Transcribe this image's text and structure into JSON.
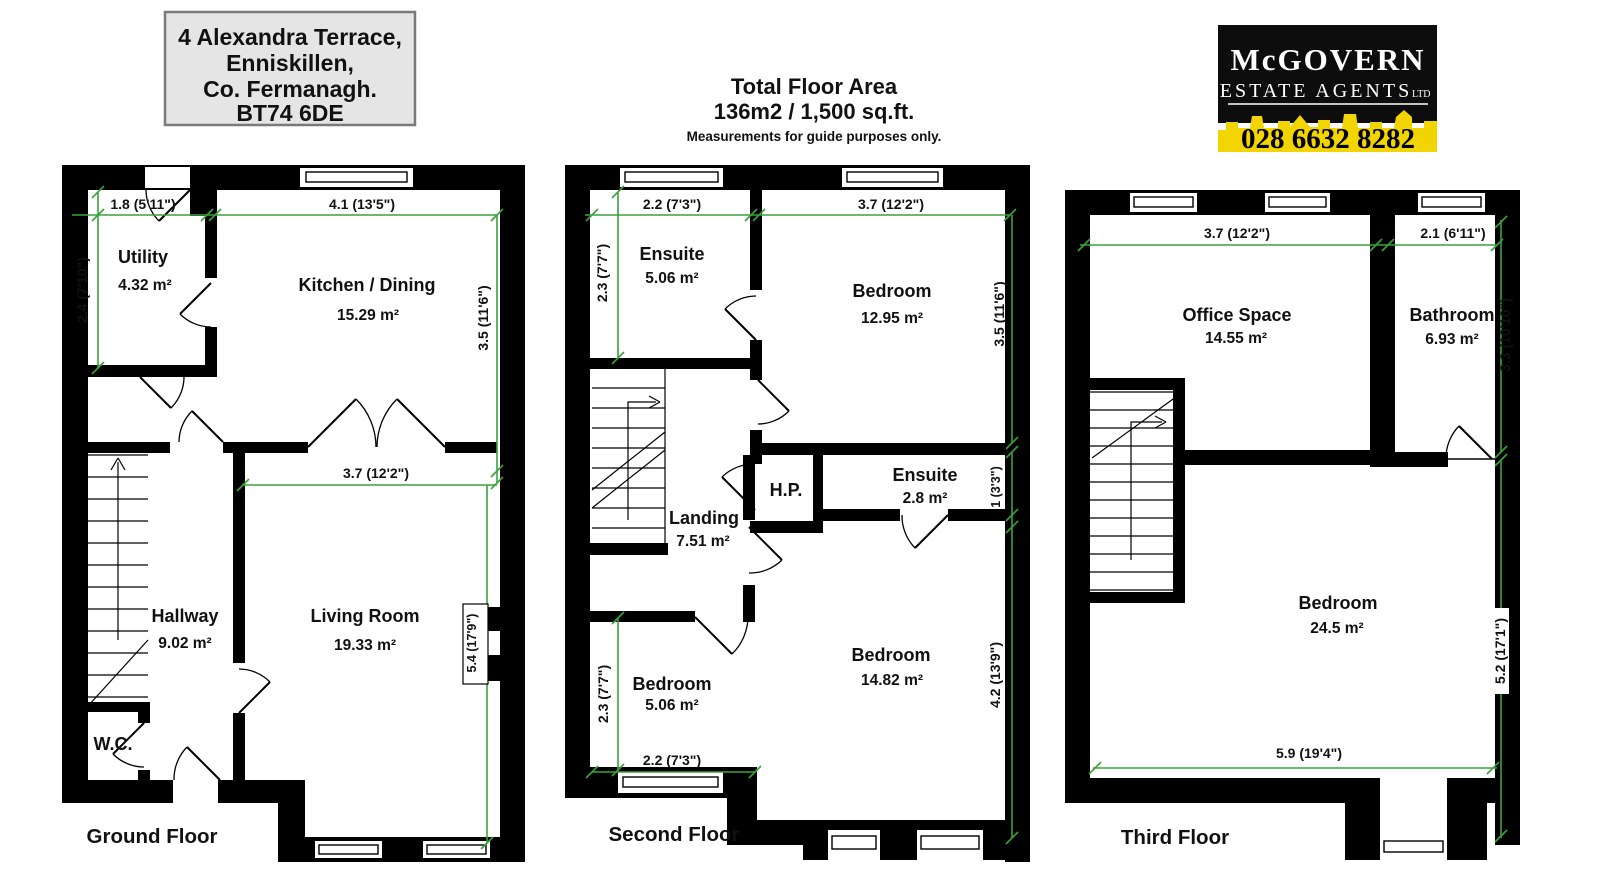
{
  "header": {
    "address": {
      "line1": "4 Alexandra Terrace,",
      "line2": "Enniskillen,",
      "line3": "Co. Fermanagh.",
      "line4": "BT74 6DE"
    },
    "total_area": {
      "title": "Total Floor Area",
      "value": "136m2 / 1,500 sq.ft.",
      "note": "Measurements for guide purposes only."
    },
    "logo": {
      "name": "McGOVERN",
      "tagline": "ESTATE AGENTS",
      "suffix": "LTD",
      "phone": "028 6632 8282"
    }
  },
  "colors": {
    "wall": "#000000",
    "dimension_green": "#3aa23a",
    "address_bg": "#e5e5e5",
    "logo_bg": "#0d0d0d",
    "logo_band_yellow": "#f2d500"
  },
  "floors": {
    "ground": {
      "title": "Ground Floor",
      "rooms": {
        "utility": {
          "name": "Utility",
          "area": "4.32 m²"
        },
        "kitchen": {
          "name": "Kitchen / Dining",
          "area": "15.29 m²"
        },
        "hallway": {
          "name": "Hallway",
          "area": "9.02 m²"
        },
        "living": {
          "name": "Living Room",
          "area": "19.33 m²"
        },
        "wc": {
          "name": "W.C."
        }
      },
      "dims": {
        "utility_width": "1.8 (5'11\")",
        "kitchen_width": "4.1 (13'5\")",
        "utility_depth": "2.4 (7'10\")",
        "kitchen_depth": "3.5 (11'6\")",
        "living_width": "3.7 (12'2\")",
        "living_depth": "5.4 (17'9\")"
      }
    },
    "second": {
      "title": "Second Floor",
      "rooms": {
        "ensuite_front": {
          "name": "Ensuite",
          "area": "5.06 m²"
        },
        "bedroom_front": {
          "name": "Bedroom",
          "area": "12.95 m²"
        },
        "landing": {
          "name": "Landing",
          "area": "7.51 m²"
        },
        "hotpress": {
          "name": "H.P."
        },
        "ensuite_mid": {
          "name": "Ensuite",
          "area": "2.8 m²"
        },
        "bedroom_small": {
          "name": "Bedroom",
          "area": "5.06 m²"
        },
        "bedroom_back": {
          "name": "Bedroom",
          "area": "14.82 m²"
        }
      },
      "dims": {
        "ensuite_width": "2.2 (7'3\")",
        "bedroom_front_width": "3.7 (12'2\")",
        "ensuite_depth": "2.3 (7'7\")",
        "bedroom_front_depth": "3.5 (11'6\")",
        "ensuite_mid_depth": "1 (3'3\")",
        "bedroom_small_depth": "2.3 (7'7\")",
        "bedroom_small_width": "2.2 (7'3\")",
        "bedroom_back_depth": "4.2 (13'9\")"
      }
    },
    "third": {
      "title": "Third Floor",
      "rooms": {
        "office": {
          "name": "Office Space",
          "area": "14.55 m²"
        },
        "bathroom": {
          "name": "Bathroom",
          "area": "6.93 m²"
        },
        "bedroom": {
          "name": "Bedroom",
          "area": "24.5 m²"
        }
      },
      "dims": {
        "office_width": "3.7 (12'2\")",
        "bathroom_width": "2.1 (6'11\")",
        "bathroom_depth": "3.3 (10'10\")",
        "bedroom_depth": "5.2 (17'1\")",
        "bedroom_width": "5.9 (19'4\")"
      }
    }
  }
}
